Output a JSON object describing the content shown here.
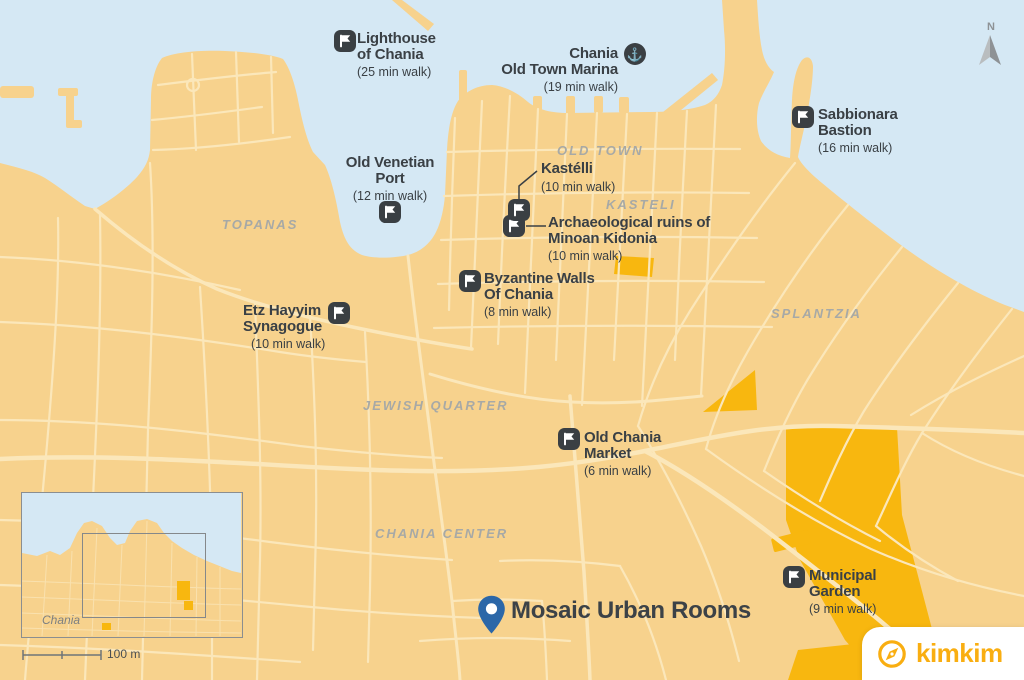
{
  "colors": {
    "water": "#D5E8F4",
    "land": "#F7D28D",
    "road": "#FBE7BA",
    "park": "#F8B70F",
    "marker": "#3A3F43",
    "poi_text": "#3A4045",
    "area_label": "#A7A9A6",
    "pin_blue": "#2B67A8",
    "brand_orange": "#F9AE11"
  },
  "icons": {
    "anchor_glyph": "⚓"
  },
  "pois": [
    {
      "id": "lighthouse",
      "icon": "flag-icon",
      "lines": [
        "Lighthouse",
        "of Chania"
      ],
      "walk": "(25 min walk)"
    },
    {
      "id": "marina",
      "icon": "anchor-icon",
      "lines": [
        "Chania",
        "Old Town Marina"
      ],
      "walk": "(19 min walk)"
    },
    {
      "id": "sabbionara",
      "icon": "flag-icon",
      "lines": [
        "Sabbionara",
        "Bastion"
      ],
      "walk": "(16 min walk)"
    },
    {
      "id": "venetian-port",
      "icon": "flag-icon",
      "lines": [
        "Old Venetian",
        "Port"
      ],
      "walk": "(12 min walk)"
    },
    {
      "id": "kastelli",
      "icon": "flag-icon",
      "lines": [
        "Kastélli"
      ],
      "walk": "(10 min walk)"
    },
    {
      "id": "minoan-ruins",
      "icon": "flag-icon",
      "lines": [
        "Archaeological ruins of",
        "Minoan Kidonia"
      ],
      "walk": "(10 min walk)"
    },
    {
      "id": "byzantine-walls",
      "icon": "flag-icon",
      "lines": [
        "Byzantine Walls",
        "Of Chania"
      ],
      "walk": "(8 min walk)"
    },
    {
      "id": "synagogue",
      "icon": "flag-icon",
      "lines": [
        "Etz Hayyim",
        "Synagogue"
      ],
      "walk": "(10 min walk)"
    },
    {
      "id": "market",
      "icon": "flag-icon",
      "lines": [
        "Old Chania",
        "Market"
      ],
      "walk": "(6 min walk)"
    },
    {
      "id": "municipal-garden",
      "icon": "flag-icon",
      "lines": [
        "Municipal",
        "Garden"
      ],
      "walk": "(9 min walk)"
    }
  ],
  "destination": {
    "name": "Mosaic Urban Rooms"
  },
  "areas": [
    "OLD TOWN",
    "KASTELI",
    "TOPANAS",
    "SPLANTZIA",
    "JEWISH QUARTER",
    "CHANIA CENTER"
  ],
  "north_label": "N",
  "inset": {
    "place_label": "Chania",
    "scale_label": "100 m"
  },
  "brand": {
    "text": "kimkim"
  }
}
